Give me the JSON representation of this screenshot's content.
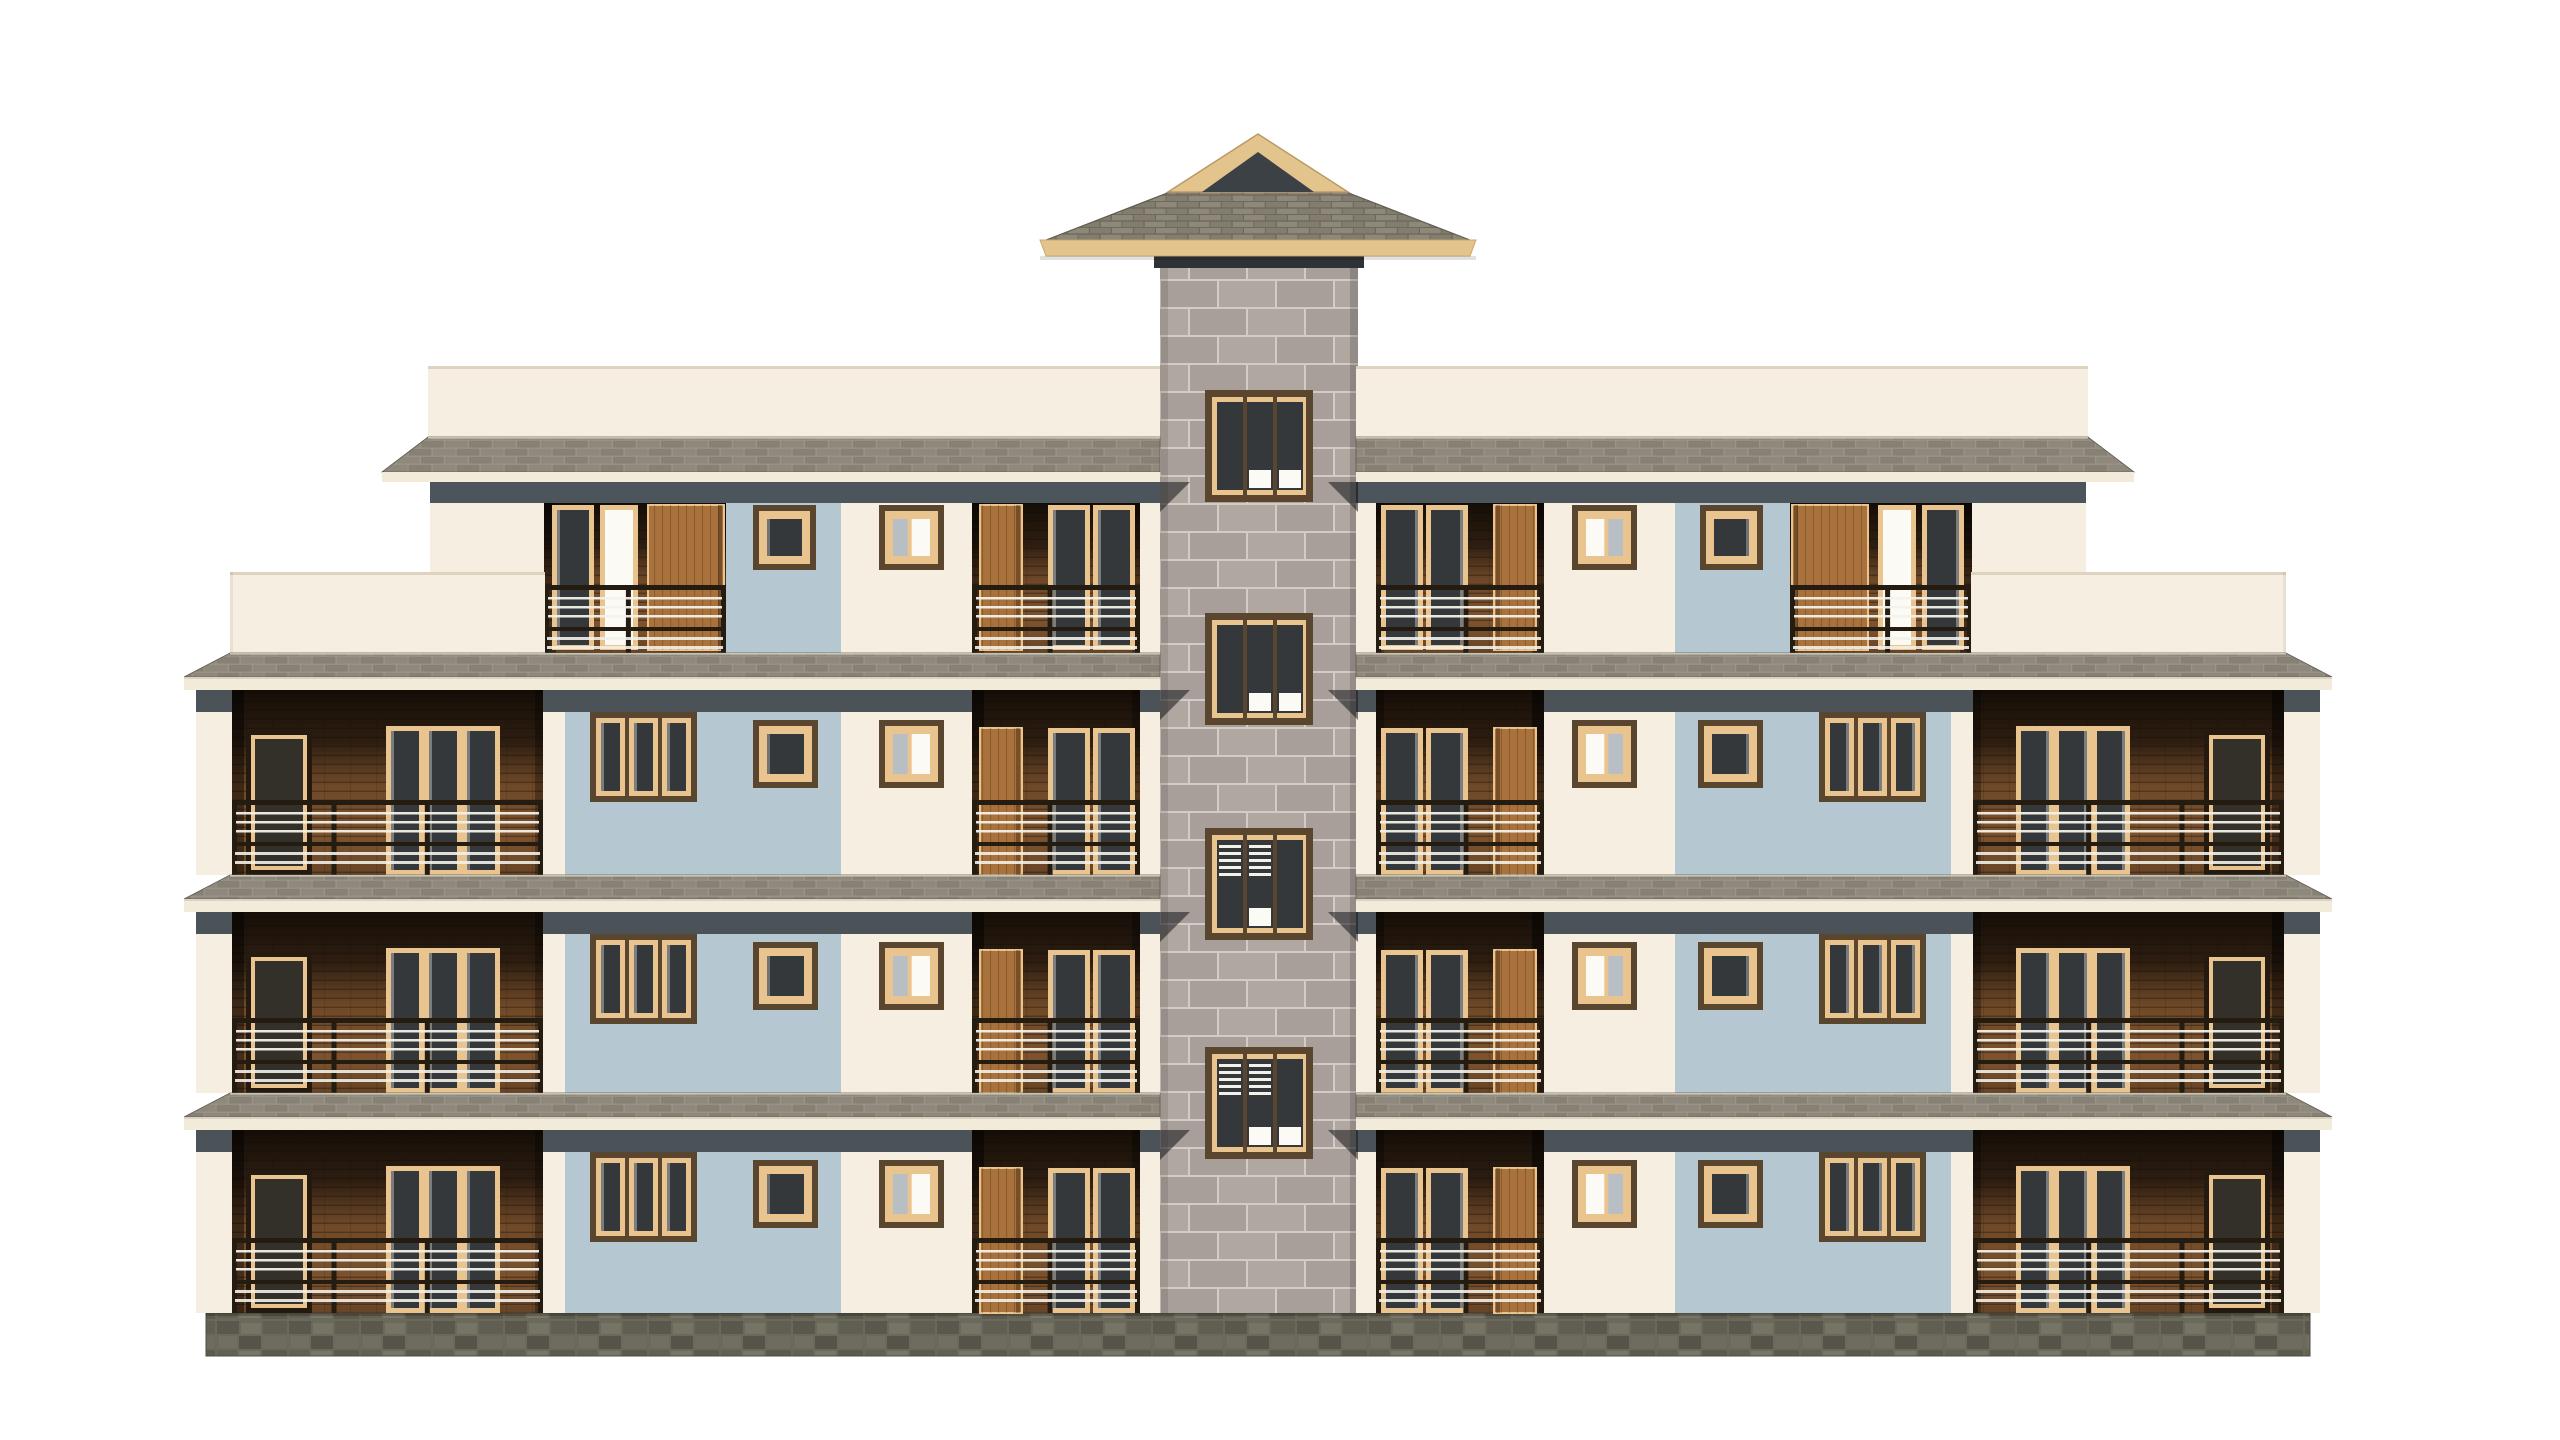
{
  "meta": {
    "description": "3D architectural front-elevation render of a symmetric four-storey apartment building with a central stone tower, white background",
    "visible_text": []
  },
  "scene": {
    "width": 2560,
    "height": 1440,
    "background": "#ffffff",
    "mirror_axis_x": 1258,
    "palette": {
      "cream_wall": "#f6efe1",
      "cream_fascia": "#f3ebda",
      "parapet_line": "#ddd3bf",
      "blue_panel": "#b5c8d1",
      "blue_panel_dark": "#a9bdc7",
      "slab_mortar": "#9b9588",
      "slab_brick_a": "#8e897c",
      "slab_brick_b": "#868174",
      "slab_top_line": "#c9c3b4",
      "roof_base": "#6e695d",
      "roof_shingle_a": "#8d8879",
      "roof_shingle_b": "#827d6f",
      "roof_fascia_tan": "#e3c48d",
      "gable_dark": "#3c4146",
      "roof_edge": "#5f5b4f",
      "masonry_mortar": "#d3cbc5",
      "masonry_block_a": "#a99f9a",
      "masonry_block_b": "#b1a7a1",
      "plinth_base": "#6b695c",
      "plinth_stones": [
        "#5a584c",
        "#767465",
        "#615f52",
        "#716f61",
        "#565448",
        "#6e6c5e",
        "#63614f",
        "#787667",
        "#5d5b4e"
      ],
      "shadow_band": "#39414a",
      "shadow_tri": "rgba(18,22,26,0.55)",
      "under_roof_band": "#2e3338",
      "wood_base": "#8a5c33",
      "wood_bright": "#a9723c",
      "plank_line": "rgba(30,18,8,0.4)",
      "frame_dark": "#5a452f",
      "frame_tan": "#e9c48e",
      "glass_dark": "#34383b",
      "glass_mid": "#b7bfc5",
      "glass_white": "#fbfaf5",
      "rail_dark": "#241b11",
      "rail_white": "#f2f1ea"
    },
    "tower": {
      "x": 1160,
      "width": 198,
      "top": 267,
      "bottom": 1313,
      "under_roof_band": {
        "x": 1154,
        "y": 246,
        "w": 210,
        "h": 22
      },
      "roof": {
        "fascia": [
          [
            1040,
            240
          ],
          [
            1476,
            240
          ],
          [
            1470,
            256
          ],
          [
            1046,
            256
          ]
        ],
        "hip": [
          [
            1046,
            240
          ],
          [
            1170,
            192
          ],
          [
            1346,
            192
          ],
          [
            1470,
            240
          ]
        ],
        "gable_outer": [
          [
            1258,
            134
          ],
          [
            1168,
            192
          ],
          [
            1348,
            192
          ]
        ],
        "gable_inner": [
          [
            1258,
            152
          ],
          [
            1202,
            192
          ],
          [
            1314,
            192
          ]
        ]
      },
      "windows": {
        "x": 1205,
        "w": 108,
        "h": 112,
        "tops": [
          390,
          613,
          828,
          1047
        ],
        "accents": [
          {
            "stripes": [],
            "bottoms": [
              1,
              2
            ]
          },
          {
            "stripes": [],
            "bottoms": [
              1,
              2
            ]
          },
          {
            "stripes": [
              0,
              1
            ],
            "bottoms": [
              1
            ]
          },
          {
            "stripes": [
              0,
              1
            ],
            "bottoms": [
              1,
              2
            ]
          }
        ]
      }
    },
    "inner_block": {
      "parapet": {
        "x0": 428,
        "x1": 1160,
        "y0": 366,
        "y1": 437
      },
      "roof_slab": {
        "tip_x": 382,
        "edge_x": 428,
        "x1": 1160,
        "y0": 437,
        "y1": 472,
        "fascia_h": 10
      },
      "shadow": {
        "x0": 430,
        "y0": 482,
        "h": 21
      },
      "floor4": {
        "wall_y0": 503,
        "wall_y1": 653,
        "rail_y": 585,
        "recess_left": {
          "x0": 544,
          "x1": 726,
          "door_glass": [
            552,
            594
          ],
          "door_white": [
            600,
            638
          ],
          "wood_panel": [
            648,
            724
          ]
        },
        "blue_panel": {
          "x0": 726,
          "x1": 841,
          "window": [
            753,
            816
          ],
          "win_y": [
            505,
            570
          ]
        },
        "cream_window": {
          "x": [
            879,
            944
          ],
          "y": [
            505,
            570
          ]
        },
        "recess_right": {
          "x0": 972,
          "x1": 1140,
          "wood_door": [
            980,
            1022
          ],
          "glazed": [
            [
              1048,
              1090
            ],
            [
              1093,
              1135
            ]
          ]
        },
        "pier": [
          1140,
          1160
        ]
      }
    },
    "wing": {
      "wall_x0": 196,
      "recess": [
        232,
        543
      ],
      "narrow_door": [
        246,
        312
      ],
      "triple_door": [
        386,
        500
      ],
      "parapet": {
        "x0": 230,
        "x1": 545,
        "y0": 572,
        "y1": 653
      }
    },
    "floors": [
      {
        "label": "third-floor",
        "shadow_y": 690,
        "top": 712,
        "bottom": 875,
        "rail_y": 800,
        "win3_y": [
          712,
          802
        ],
        "wins_y": [
          720,
          788
        ]
      },
      {
        "label": "second-floor",
        "shadow_y": 912,
        "top": 934,
        "bottom": 1093,
        "rail_y": 1018,
        "win3_y": [
          934,
          1024
        ],
        "wins_y": [
          942,
          1010
        ]
      },
      {
        "label": "first-floor",
        "shadow_y": 1130,
        "top": 1152,
        "bottom": 1313,
        "rail_y": 1238,
        "win3_y": [
          1152,
          1242
        ],
        "wins_y": [
          1160,
          1228
        ]
      }
    ],
    "floor_x": {
      "wall": [
        196,
        1160
      ],
      "blue": [
        565,
        841
      ],
      "win3": [
        590,
        697
      ],
      "win_small_blue": [
        753,
        818
      ],
      "win_small_cream": [
        879,
        944
      ],
      "recess_inner": [
        972,
        1140
      ],
      "wood_door": [
        980,
        1022
      ],
      "glazed_pair": [
        [
          1048,
          1090
        ],
        [
          1093,
          1135
        ]
      ],
      "pier_right": [
        1140,
        1160
      ]
    },
    "slabs": {
      "tops": [
        653,
        875,
        1093
      ],
      "tip_x": 184,
      "edge_x": 230,
      "x1": 1160,
      "h": 24,
      "fascia_h": 13
    },
    "plinth": {
      "x0": 206,
      "x1": 2310,
      "y0": 1313,
      "y1": 1356
    }
  }
}
